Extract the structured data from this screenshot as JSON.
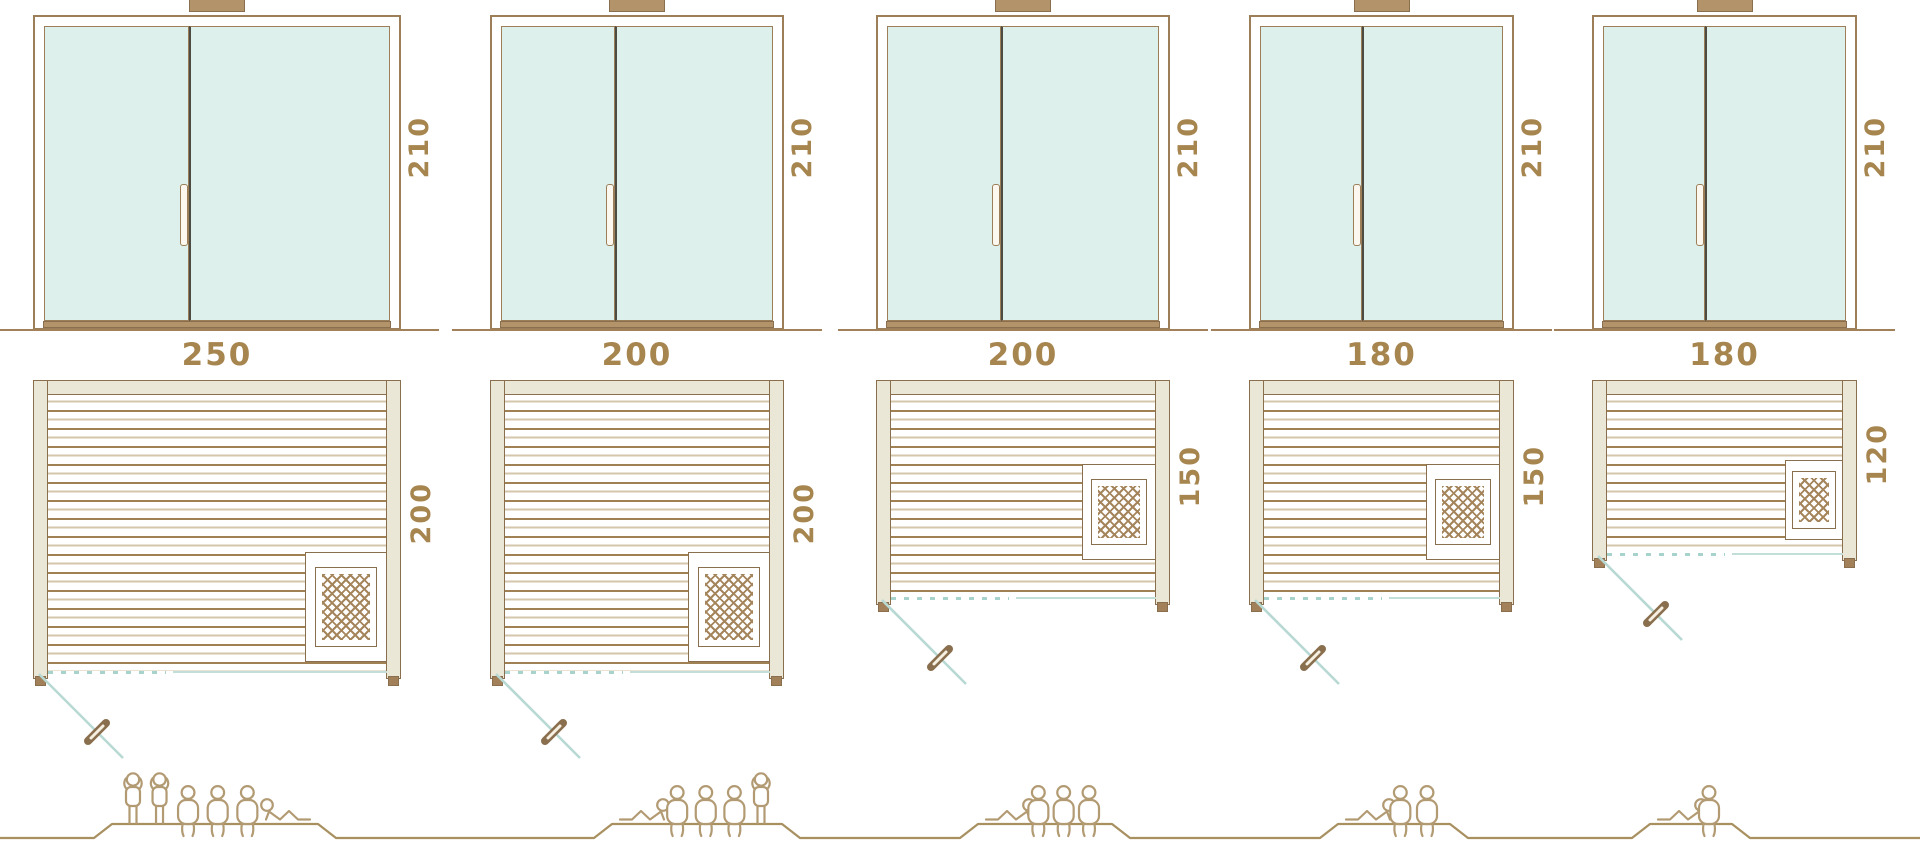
{
  "palette": {
    "outline_brown": "#8a6f4e",
    "frame_brown": "#9c7f58",
    "wood_dark_line": "#9f8153",
    "wood_light_line": "#d3c6ab",
    "frame_beige": "#eae7d7",
    "glass_mint": "#def0ec",
    "divider_dark": "#4c4c42",
    "sill_tan": "#b3936a",
    "ground_tan": "#a2815a",
    "accent_teal": "#b8d9d3",
    "label_brown": "#a6854f",
    "figure_tan": "#b29a73"
  },
  "saunas": [
    {
      "name": "sauna-250x200",
      "width_cm": "250",
      "depth_cm": "200",
      "height_cm": "210",
      "capacity_figures": [
        "standing",
        "standing",
        "sitting",
        "sitting",
        "sitting",
        "lying_head_left"
      ]
    },
    {
      "name": "sauna-200x200",
      "width_cm": "200",
      "depth_cm": "200",
      "height_cm": "210",
      "capacity_figures": [
        "lying_head_right",
        "sitting",
        "sitting",
        "sitting",
        "standing"
      ]
    },
    {
      "name": "sauna-200x150",
      "width_cm": "200",
      "depth_cm": "150",
      "height_cm": "210",
      "capacity_figures": [
        "lying_head_right",
        "sitting",
        "sitting",
        "sitting"
      ]
    },
    {
      "name": "sauna-180x150",
      "width_cm": "180",
      "depth_cm": "150",
      "height_cm": "210",
      "capacity_figures": [
        "lying_head_right",
        "sitting",
        "sitting"
      ]
    },
    {
      "name": "sauna-180x120",
      "width_cm": "180",
      "depth_cm": "120",
      "height_cm": "210",
      "capacity_figures": [
        "lying_head_right",
        "sitting"
      ]
    }
  ]
}
